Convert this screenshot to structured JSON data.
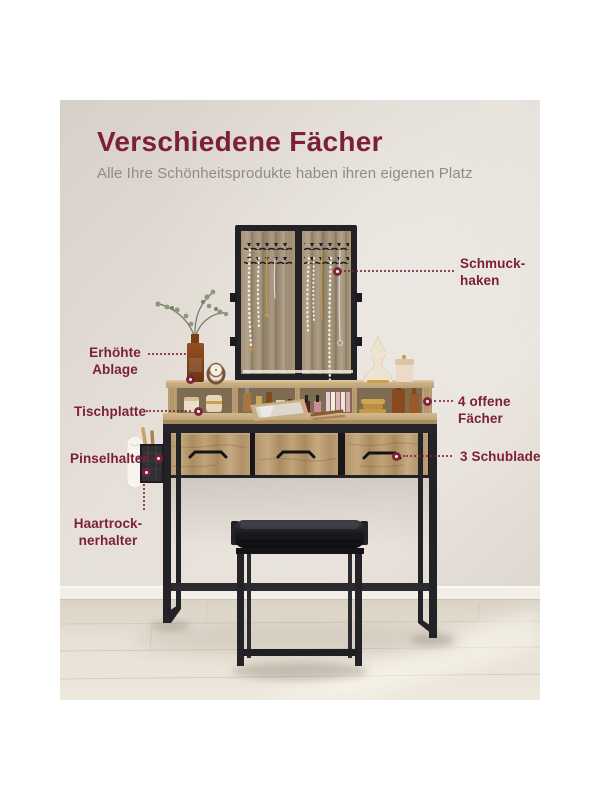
{
  "header": {
    "title": "Verschiedene Fächer",
    "subtitle": "Alle Ihre Schönheitsprodukte haben ihren eigenen Platz"
  },
  "annotations": {
    "schmuckhaken": {
      "line1": "Schmuck-",
      "line2": "haken"
    },
    "erhoehte_ablage": {
      "line1": "Erhöhte",
      "line2": "Ablage"
    },
    "tischplatte": {
      "label": "Tischplatte"
    },
    "pinselhalter": {
      "label": "Pinselhalter"
    },
    "haartrocknerhalter": {
      "line1": "Haartrock-",
      "line2": "nerhalter"
    },
    "offene_faecher": {
      "line1": "4 offene",
      "line2": "Fächer"
    },
    "schubladen": {
      "label": "3 Schubladen"
    }
  },
  "colors": {
    "accent": "#7C2038",
    "subtitle": "#8C8C8C",
    "wall": "#E6E0D9",
    "baseboard": "#F2EFE9",
    "floor": "#E7E0D4",
    "wood_warm": "#BB9E74",
    "wood_gray": "#A4957E",
    "metal_black": "#26262A",
    "cushion_black": "#141416",
    "gold": "#C9A14E",
    "pearl": "#F1EDE3"
  }
}
